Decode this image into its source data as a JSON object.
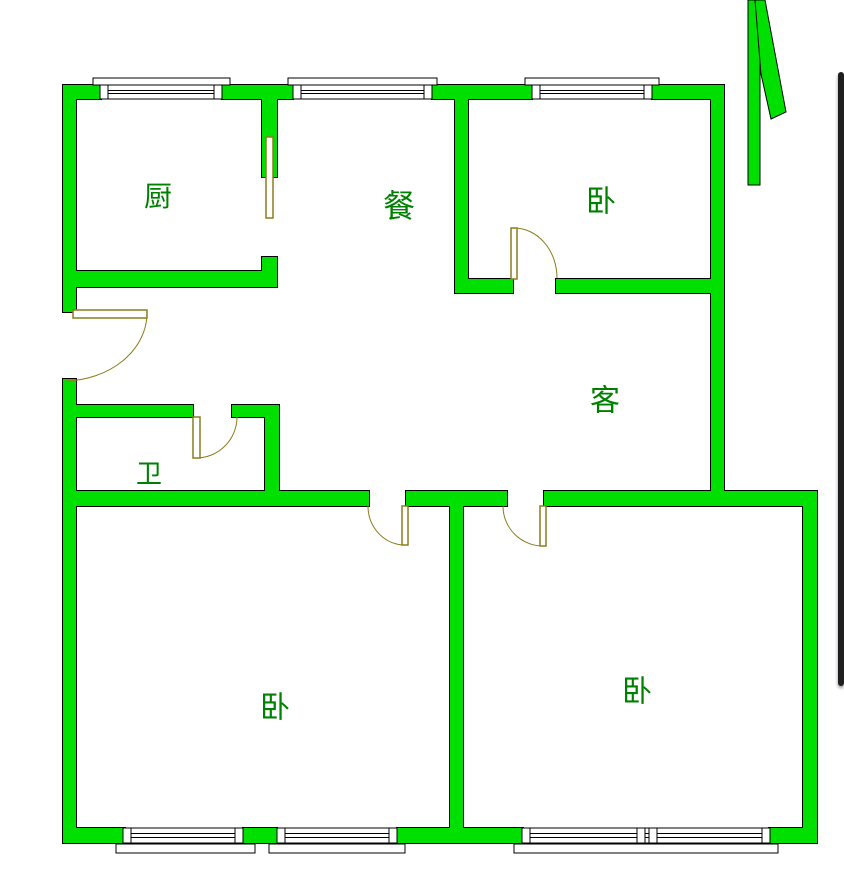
{
  "canvas": {
    "width": 844,
    "height": 878,
    "background": "#ffffff"
  },
  "palette": {
    "wall_fill": "#00e000",
    "wall_stroke": "#000000",
    "door_color": "#8a7d1e",
    "window_stroke": "#000000",
    "window_fill": "#ffffff",
    "label_color": "#008000",
    "scrollbar_color": "#1f1f1f"
  },
  "config": {
    "window_post_width": 8,
    "wall_outline_width": 2
  },
  "rooms": [
    {
      "id": "kitchen",
      "label": "厨",
      "x": 158,
      "y": 196,
      "size": 28
    },
    {
      "id": "dining",
      "label": "餐",
      "x": 399,
      "y": 206,
      "size": 32
    },
    {
      "id": "bedroom-north",
      "label": "卧",
      "x": 601,
      "y": 201,
      "size": 30
    },
    {
      "id": "living",
      "label": "客",
      "x": 605,
      "y": 400,
      "size": 30
    },
    {
      "id": "bathroom",
      "label": "卫",
      "x": 149,
      "y": 474,
      "size": 26
    },
    {
      "id": "bedroom-southwest",
      "label": "卧",
      "x": 275,
      "y": 707,
      "size": 30
    },
    {
      "id": "bedroom-southeast",
      "label": "卧",
      "x": 637,
      "y": 691,
      "size": 30
    }
  ],
  "walls": [
    {
      "id": "top-1",
      "r": [
        63,
        85,
        38,
        14
      ]
    },
    {
      "id": "top-2",
      "r": [
        222,
        85,
        71,
        14
      ]
    },
    {
      "id": "top-3",
      "r": [
        432,
        85,
        100,
        14
      ]
    },
    {
      "id": "top-4",
      "r": [
        652,
        85,
        72,
        14
      ]
    },
    {
      "id": "left-upper",
      "r": [
        63,
        85,
        13,
        227
      ]
    },
    {
      "id": "left-lower",
      "r": [
        63,
        379,
        13,
        464
      ]
    },
    {
      "id": "right-upper",
      "r": [
        711,
        85,
        13,
        421
      ]
    },
    {
      "id": "kitchen-partition",
      "r": [
        262,
        99,
        15,
        78
      ]
    },
    {
      "id": "kitchen-stub",
      "r": [
        262,
        257,
        15,
        30
      ]
    },
    {
      "id": "kitchen-south",
      "r": [
        75,
        271,
        202,
        16
      ]
    },
    {
      "id": "bedroomN-west",
      "r": [
        455,
        99,
        13,
        194
      ]
    },
    {
      "id": "bedroomN-south-1",
      "r": [
        455,
        279,
        58,
        14
      ]
    },
    {
      "id": "bedroomN-south-2",
      "r": [
        556,
        279,
        168,
        14
      ]
    },
    {
      "id": "bath-north-1",
      "r": [
        75,
        405,
        118,
        12
      ]
    },
    {
      "id": "bath-north-2",
      "r": [
        232,
        405,
        45,
        12
      ]
    },
    {
      "id": "bath-east",
      "r": [
        265,
        405,
        14,
        93
      ]
    },
    {
      "id": "corridor-1",
      "r": [
        63,
        491,
        306,
        15
      ]
    },
    {
      "id": "corridor-2",
      "r": [
        406,
        491,
        101,
        15
      ]
    },
    {
      "id": "corridor-3",
      "r": [
        544,
        491,
        273,
        15
      ]
    },
    {
      "id": "bedrooms-divider",
      "r": [
        450,
        491,
        13,
        351
      ]
    },
    {
      "id": "right-lower",
      "r": [
        803,
        491,
        14,
        352
      ]
    },
    {
      "id": "bottom-1",
      "r": [
        63,
        828,
        62,
        15
      ]
    },
    {
      "id": "bottom-2",
      "r": [
        243,
        828,
        34,
        15
      ]
    },
    {
      "id": "bottom-3",
      "r": [
        397,
        828,
        126,
        15
      ]
    },
    {
      "id": "bottom-4",
      "r": [
        769,
        828,
        48,
        15
      ]
    }
  ],
  "windows": [
    {
      "id": "kitchen-window",
      "r": [
        100,
        85,
        122,
        14
      ],
      "sill": [
        93,
        78,
        137,
        7
      ],
      "posts": [
        100,
        214
      ]
    },
    {
      "id": "dining-window",
      "r": [
        293,
        85,
        139,
        14
      ],
      "sill": [
        288,
        78,
        149,
        7
      ],
      "posts": [
        293,
        424
      ]
    },
    {
      "id": "bedroomN-window",
      "r": [
        532,
        85,
        120,
        14
      ],
      "sill": [
        525,
        78,
        134,
        7
      ],
      "posts": [
        532,
        644
      ]
    },
    {
      "id": "bedroomSW-window-1",
      "r": [
        123,
        828,
        120,
        15
      ],
      "sill": [
        116,
        844,
        139,
        9
      ],
      "posts": [
        123,
        235
      ]
    },
    {
      "id": "bedroomSW-window-2",
      "r": [
        277,
        828,
        120,
        15
      ],
      "sill": [
        269,
        844,
        136,
        9
      ],
      "posts": [
        277,
        389
      ]
    },
    {
      "id": "bedroomSE-window",
      "r": [
        522,
        828,
        248,
        15
      ],
      "sill": [
        514,
        844,
        264,
        9
      ],
      "posts": [
        522,
        637,
        649,
        762
      ]
    }
  ],
  "doors": [
    {
      "id": "entrance-door",
      "leaf": [
        73,
        310,
        74,
        8
      ],
      "arc": "M 147 314 A 84 68 0 0 1 66 381"
    },
    {
      "id": "kitchen-sliding-door",
      "leaf": [
        266,
        137,
        7,
        81
      ],
      "arc": ""
    },
    {
      "id": "bathroom-door",
      "leaf": [
        193,
        417,
        7,
        41
      ],
      "arc": "M 196 458 A 41 41 0 0 0 237 417"
    },
    {
      "id": "bedroomN-door",
      "leaf": [
        511,
        228,
        6,
        51
      ],
      "arc": "M 514 228 A 43 50 0 0 1 557 278"
    },
    {
      "id": "bedroomSW-door",
      "leaf": [
        402,
        506,
        6,
        39
      ],
      "arc": "M 368 506 A 37 39 0 0 0 405 545"
    },
    {
      "id": "bedroomSE-door",
      "leaf": [
        540,
        506,
        6,
        40
      ],
      "arc": "M 503 506 A 40 40 0 0 0 543 546"
    }
  ],
  "north_arrow": {
    "bar": [
      748,
      0,
      12,
      185
    ],
    "blade": "755,0 765,0 786,112 771,119 761,74"
  },
  "scrollbar": {
    "x": 838,
    "y": 72,
    "width": 6,
    "height": 614
  }
}
